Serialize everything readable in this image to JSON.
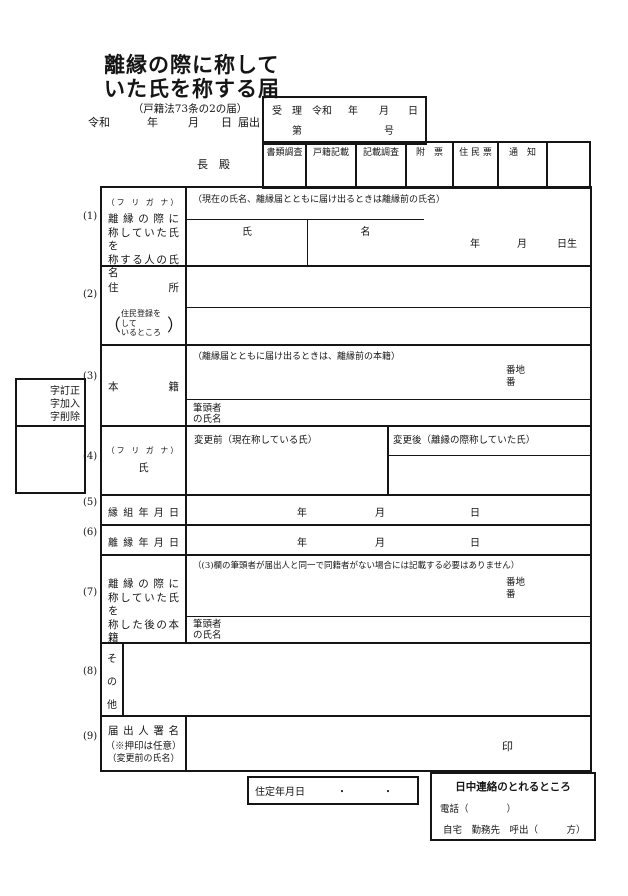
{
  "header": {
    "title_line1": "離縁の際に称して",
    "title_line2": "いた氏を称する届",
    "subtitle": "（戸籍法73条の2の届）",
    "filing_date": {
      "era": "令和",
      "year": "年",
      "month": "月",
      "day": "日",
      "suffix": "届出"
    },
    "addressee": "長　殿",
    "reception": {
      "label": "受　理",
      "era": "令和",
      "year": "年",
      "month": "月",
      "day": "日",
      "num_prefix": "第",
      "num_suffix": "号"
    },
    "stamps": [
      "書類調査",
      "戸籍記載",
      "記載調査",
      "附　票",
      "住 民 票",
      "通　知",
      ""
    ]
  },
  "margin": {
    "row_numbers": [
      "(1)",
      "(2)",
      "(3)",
      "(4)",
      "(5)",
      "(6)",
      "(7)",
      "(8)",
      "(9)"
    ],
    "correction_lines": [
      "字訂正",
      "字加入",
      "字削除"
    ]
  },
  "rows": {
    "r1": {
      "furigana": "（フ リ ガ ナ）",
      "label1": "離 縁 の 際 に",
      "label2": "称していた氏を",
      "label3": "称する人の氏名",
      "note": "（現在の氏名、離縁届とともに届け出るときは離縁前の氏名）",
      "last_name": "氏",
      "first_name": "名",
      "birth_year": "年",
      "birth_month": "月",
      "birth_day": "日生"
    },
    "r2": {
      "label": "住 所",
      "sub1": "住民登録をして",
      "sub2": "いるところ",
      "paren_open": "（",
      "paren_close": "）"
    },
    "r3": {
      "label": "本 籍",
      "note": "（離縁届とともに届け出るときは、離縁前の本籍）",
      "banchi": "番地",
      "ban": "番",
      "head1": "筆頭者",
      "head2": "の氏名"
    },
    "r4": {
      "furigana": "（フ リ ガ ナ）",
      "label": "氏",
      "before": "変更前（現在称している氏）",
      "after": "変更後（離縁の際称していた氏）"
    },
    "r5": {
      "label": "縁 組 年 月 日",
      "year": "年",
      "month": "月",
      "day": "日"
    },
    "r6": {
      "label": "離 縁 年 月 日",
      "year": "年",
      "month": "月",
      "day": "日"
    },
    "r7": {
      "label1": "離 縁 の 際 に",
      "label2": "称していた氏を",
      "label3": "称した後の本籍",
      "note": "（(3)欄の筆頭者が届出人と同一で同籍者がない場合には記載する必要はありません）",
      "banchi": "番地",
      "ban": "番",
      "head1": "筆頭者",
      "head2": "の氏名"
    },
    "r8": {
      "c1": "そ",
      "c2": "の",
      "c3": "他"
    },
    "r9": {
      "label1": "届 出 人 署 名",
      "label2": "（※押印は任意）",
      "label3": "（変更前の氏名）",
      "seal": "印"
    }
  },
  "footer": {
    "juutei": {
      "label": "住定年月日",
      "dot1": "・",
      "dot2": "・"
    },
    "contact": {
      "title": "日中連絡のとれるところ",
      "tel": "電話（　　　　）",
      "line2": "自宅　勤務先　呼出（　　　方）"
    }
  }
}
